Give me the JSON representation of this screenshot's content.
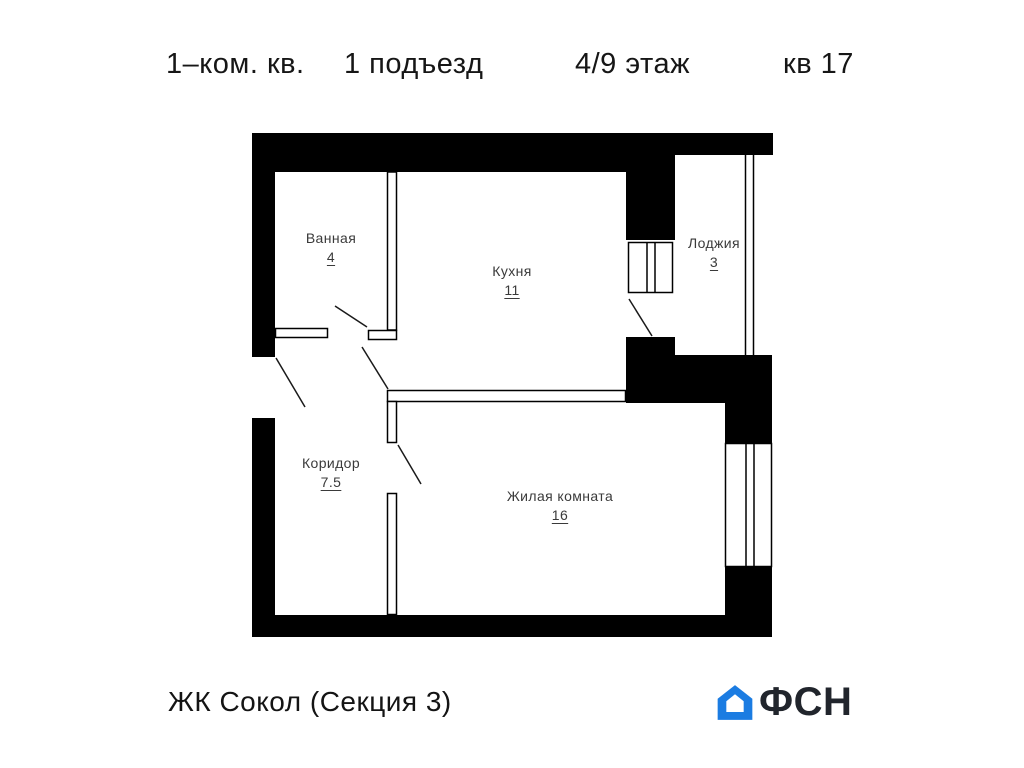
{
  "header": {
    "apartment_type": "1–ком. кв.",
    "entrance": "1 подъезд",
    "floor": "4/9 этаж",
    "apartment_number": "кв 17"
  },
  "rooms": [
    {
      "name": "Ванная",
      "area": "4"
    },
    {
      "name": "Кухня",
      "area": "11"
    },
    {
      "name": "Лоджия",
      "area": "3"
    },
    {
      "name": "Коридор",
      "area": "7.5"
    },
    {
      "name": "Жилая комната",
      "area": "16"
    }
  ],
  "footer": {
    "project": "ЖК Сокол (Секция 3)",
    "logo_text": "ФСН"
  },
  "colors": {
    "walls": "#000000",
    "logo_blue": "#1b7ce2",
    "logo_dark": "#21252c"
  }
}
